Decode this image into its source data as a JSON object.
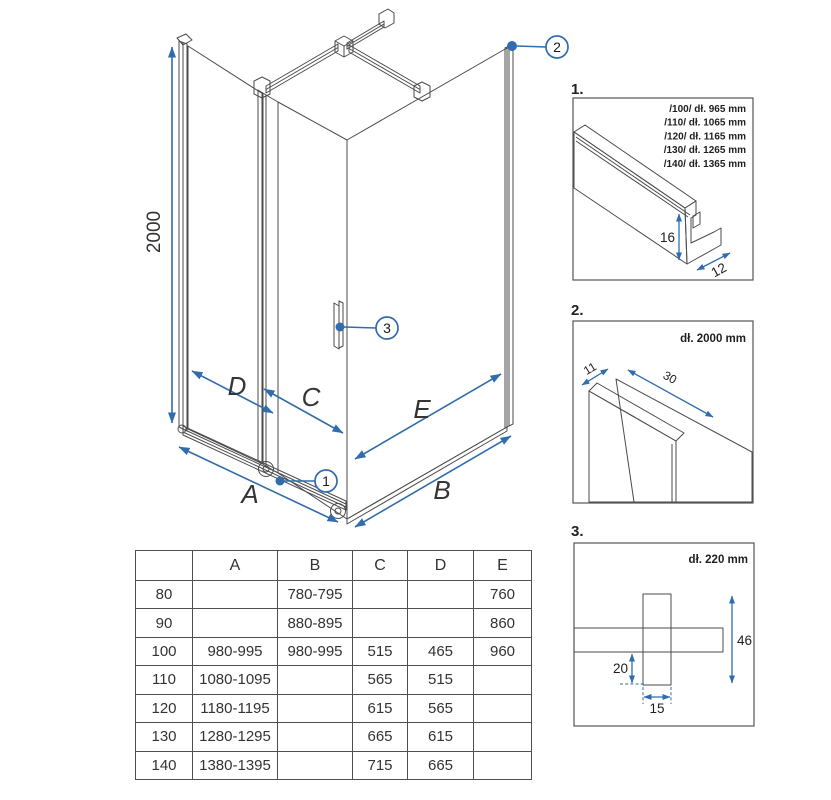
{
  "colors": {
    "accent_blue": "#306cae",
    "glass_blue": "#cde2ef",
    "glass_light": "#ddebf6",
    "metal_grey": "#e3e0dd",
    "line_dark": "#4b4b4b"
  },
  "main_diagram": {
    "height_dim": "2000",
    "dim_d": "D",
    "dim_c": "C",
    "dim_e": "E",
    "dim_a": "A",
    "dim_b": "B",
    "callout_1": "1",
    "callout_2": "2",
    "callout_3": "3"
  },
  "detail_1": {
    "number": "1.",
    "size_lines": [
      "/100/ dł. 965 mm",
      "/110/ dł. 1065 mm",
      "/120/ dł. 1165 mm",
      "/130/ dł. 1265 mm",
      "/140/ dł. 1365 mm"
    ],
    "dim_height": "16",
    "dim_depth": "12"
  },
  "detail_2": {
    "number": "2.",
    "length_label": "dł. 2000 mm",
    "dim_depth": "11",
    "dim_width": "30"
  },
  "detail_3": {
    "number": "3.",
    "length_label": "dł. 220 mm",
    "dim_height": "46",
    "dim_offset": "20",
    "dim_width": "15"
  },
  "table": {
    "headers": [
      "",
      "A",
      "B",
      "C",
      "D",
      "E"
    ],
    "rows": [
      [
        "80",
        "",
        "780-795",
        "",
        "",
        "760"
      ],
      [
        "90",
        "",
        "880-895",
        "",
        "",
        "860"
      ],
      [
        "100",
        "980-995",
        "980-995",
        "515",
        "465",
        "960"
      ],
      [
        "110",
        "1080-1095",
        "",
        "565",
        "515",
        ""
      ],
      [
        "120",
        "1180-1195",
        "",
        "615",
        "565",
        ""
      ],
      [
        "130",
        "1280-1295",
        "",
        "665",
        "615",
        ""
      ],
      [
        "140",
        "1380-1395",
        "",
        "715",
        "665",
        ""
      ]
    ]
  }
}
